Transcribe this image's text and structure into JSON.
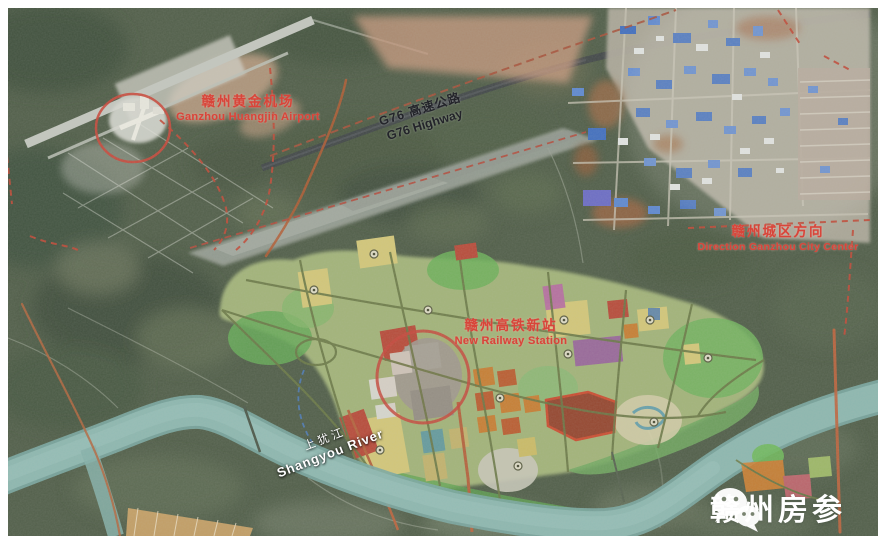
{
  "labels": {
    "airport": {
      "zh": "赣州黄金机场",
      "en": "Ganzhou Huangjin Airport"
    },
    "highway": {
      "zh": "G76  高速公路",
      "en": "G76 Highway"
    },
    "city_center": {
      "zh": "赣州城区方向",
      "en": "Direction Ganzhou City Center"
    },
    "station": {
      "zh": "赣州高铁新站",
      "en": "New Railway Station"
    },
    "river": {
      "zh": "上犹江",
      "en": "Shangyou River"
    }
  },
  "watermark": {
    "text": "赣州房参",
    "icon": "wechat-icon"
  },
  "colors": {
    "label_red": "#d8453a",
    "highway_text": "#23242a",
    "river_text": "#ffffff",
    "river_water": "#8db8b2",
    "boundary_red": "#c24534",
    "plan_yellow": "#e6d47f",
    "plan_orange": "#d8812f",
    "plan_red": "#c64536",
    "plan_green": "#6fbb5a",
    "plan_purple": "#a05fa8",
    "plan_gray": "#a7a49c",
    "plan_teal": "#5d9fae",
    "frame": "#ffffff"
  }
}
